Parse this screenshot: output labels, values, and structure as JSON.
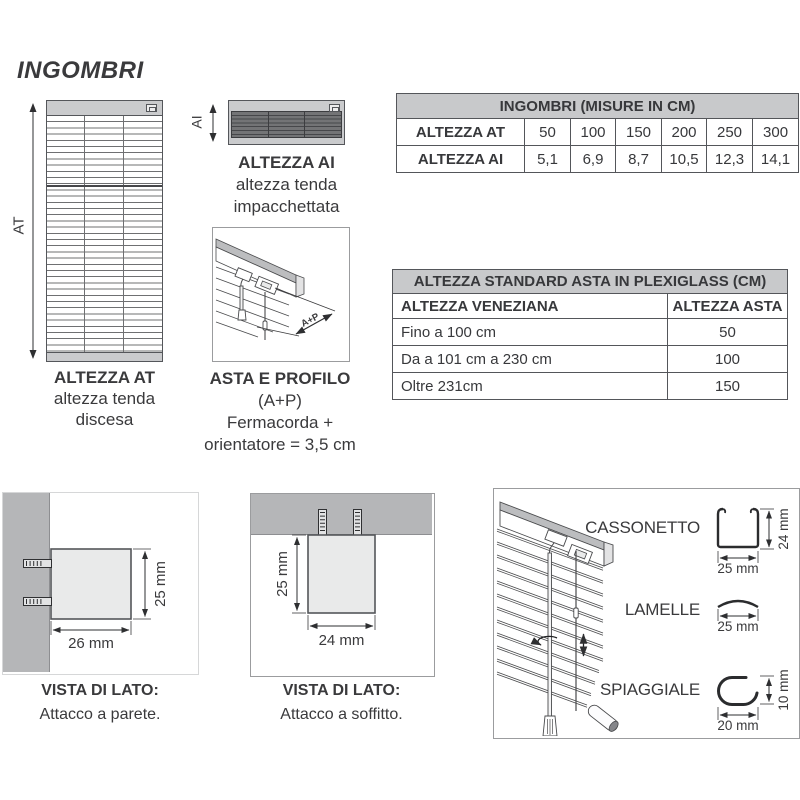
{
  "colors": {
    "text": "#3a3a3c",
    "table_header_gray": "#c8c9cb",
    "wall_gray": "#b5b6b8",
    "blind_gray": "#cacbcd",
    "slat_dark": "#737476",
    "line": "#54565a"
  },
  "title": "INGOMBRI",
  "at": {
    "arrow_label": "AT",
    "caption": [
      "ALTEZZA AT",
      "altezza tenda",
      "discesa"
    ]
  },
  "ai": {
    "arrow_label": "AI",
    "caption": [
      "ALTEZZA AI",
      "altezza tenda",
      "impacchettata"
    ]
  },
  "asta": {
    "arrow_label": "A+P",
    "caption": [
      "ASTA E PROFILO",
      "(A+P)",
      "Fermacorda +",
      "orientatore = 3,5 cm"
    ]
  },
  "tables": {
    "ingombri": {
      "title": "INGOMBRI (MISURE IN CM)",
      "rows": [
        {
          "label": "ALTEZZA AT",
          "values": [
            "50",
            "100",
            "150",
            "200",
            "250",
            "300"
          ]
        },
        {
          "label": "ALTEZZA AI",
          "values": [
            "5,1",
            "6,9",
            "8,7",
            "10,5",
            "12,3",
            "14,1"
          ]
        }
      ]
    },
    "asta_plexiglass": {
      "title": "ALTEZZA STANDARD ASTA IN PLEXIGLASS (CM)",
      "col_headers": [
        "ALTEZZA VENEZIANA",
        "ALTEZZA ASTA"
      ],
      "rows": [
        {
          "range": "Fino a 100 cm",
          "asta": "50"
        },
        {
          "range": "Da a 101 cm a 230 cm",
          "asta": "100"
        },
        {
          "range": "Oltre 231cm",
          "asta": "150"
        }
      ]
    }
  },
  "parete": {
    "dim_h": "25 mm",
    "dim_w": "26 mm",
    "caption": [
      "VISTA DI LATO:",
      "Attacco a parete."
    ]
  },
  "soffitto": {
    "dim_h": "25 mm",
    "dim_w": "24 mm",
    "caption": [
      "VISTA DI LATO:",
      "Attacco a soffitto."
    ]
  },
  "profiles": {
    "cassonetto": {
      "label": "CASSONETTO",
      "dim_h": "24 mm",
      "dim_w": "25 mm"
    },
    "lamelle": {
      "label": "LAMELLE",
      "dim_w": "25 mm"
    },
    "spiaggiale": {
      "label": "SPIAGGIALE",
      "dim_h": "10 mm",
      "dim_w": "20 mm"
    }
  }
}
